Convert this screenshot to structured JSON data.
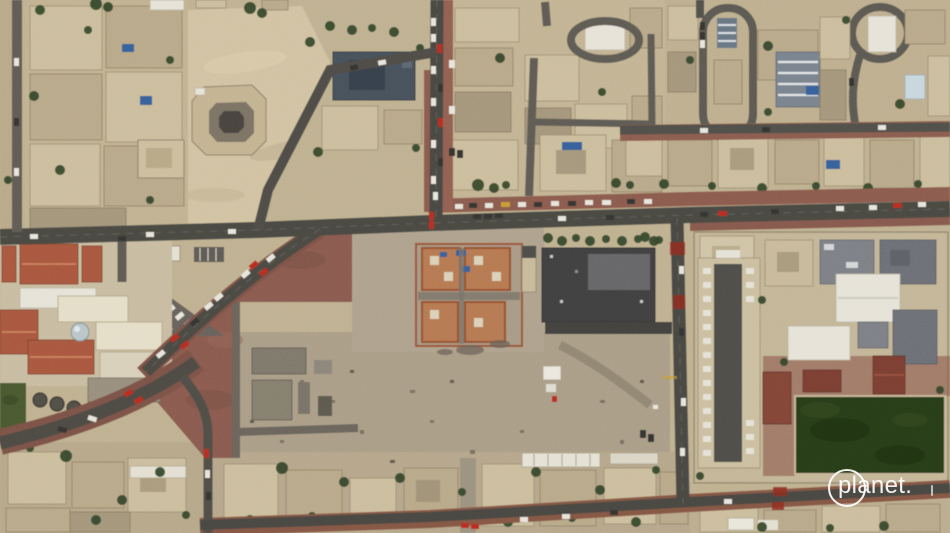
{
  "watermark": {
    "text": "planet.",
    "icon": "planet-logo-circle"
  },
  "scene": {
    "kind": "satellite-aerial-photograph",
    "features": [
      "residential-villa-blocks",
      "vacant-sand-lot",
      "octagonal-courtyard-villa",
      "main-boulevard",
      "diagonal-avenue",
      "sweeping-curve-road",
      "red-paved-plaza",
      "truck-parking-triangle",
      "construction-site",
      "dark-roofed-warehouse",
      "water-tanks",
      "green-lawn",
      "school-campus",
      "long-parking-canopy",
      "white-roof-halls",
      "terracotta-roof-buildings",
      "sports-field",
      "street-cars",
      "planet-watermark"
    ]
  },
  "palette": {
    "sand": "#c7bb9f",
    "sand_light": "#d6c9ac",
    "sand_gray": "#b5aa97",
    "road": "#54534d",
    "red_pavement": "#9c6b5b",
    "building_light": "#d2c6aa",
    "building_mid": "#c2b499",
    "white_roof": "#e9e6dd",
    "dark_roof": "#4b4b4c",
    "orange_roof": "#b3654a",
    "construction_orange": "#bf8a5e",
    "tree_green": "#3c5130",
    "field_green": "#2f461f",
    "pool_blue": "#3f6fa8",
    "car_red": "#c23425"
  }
}
